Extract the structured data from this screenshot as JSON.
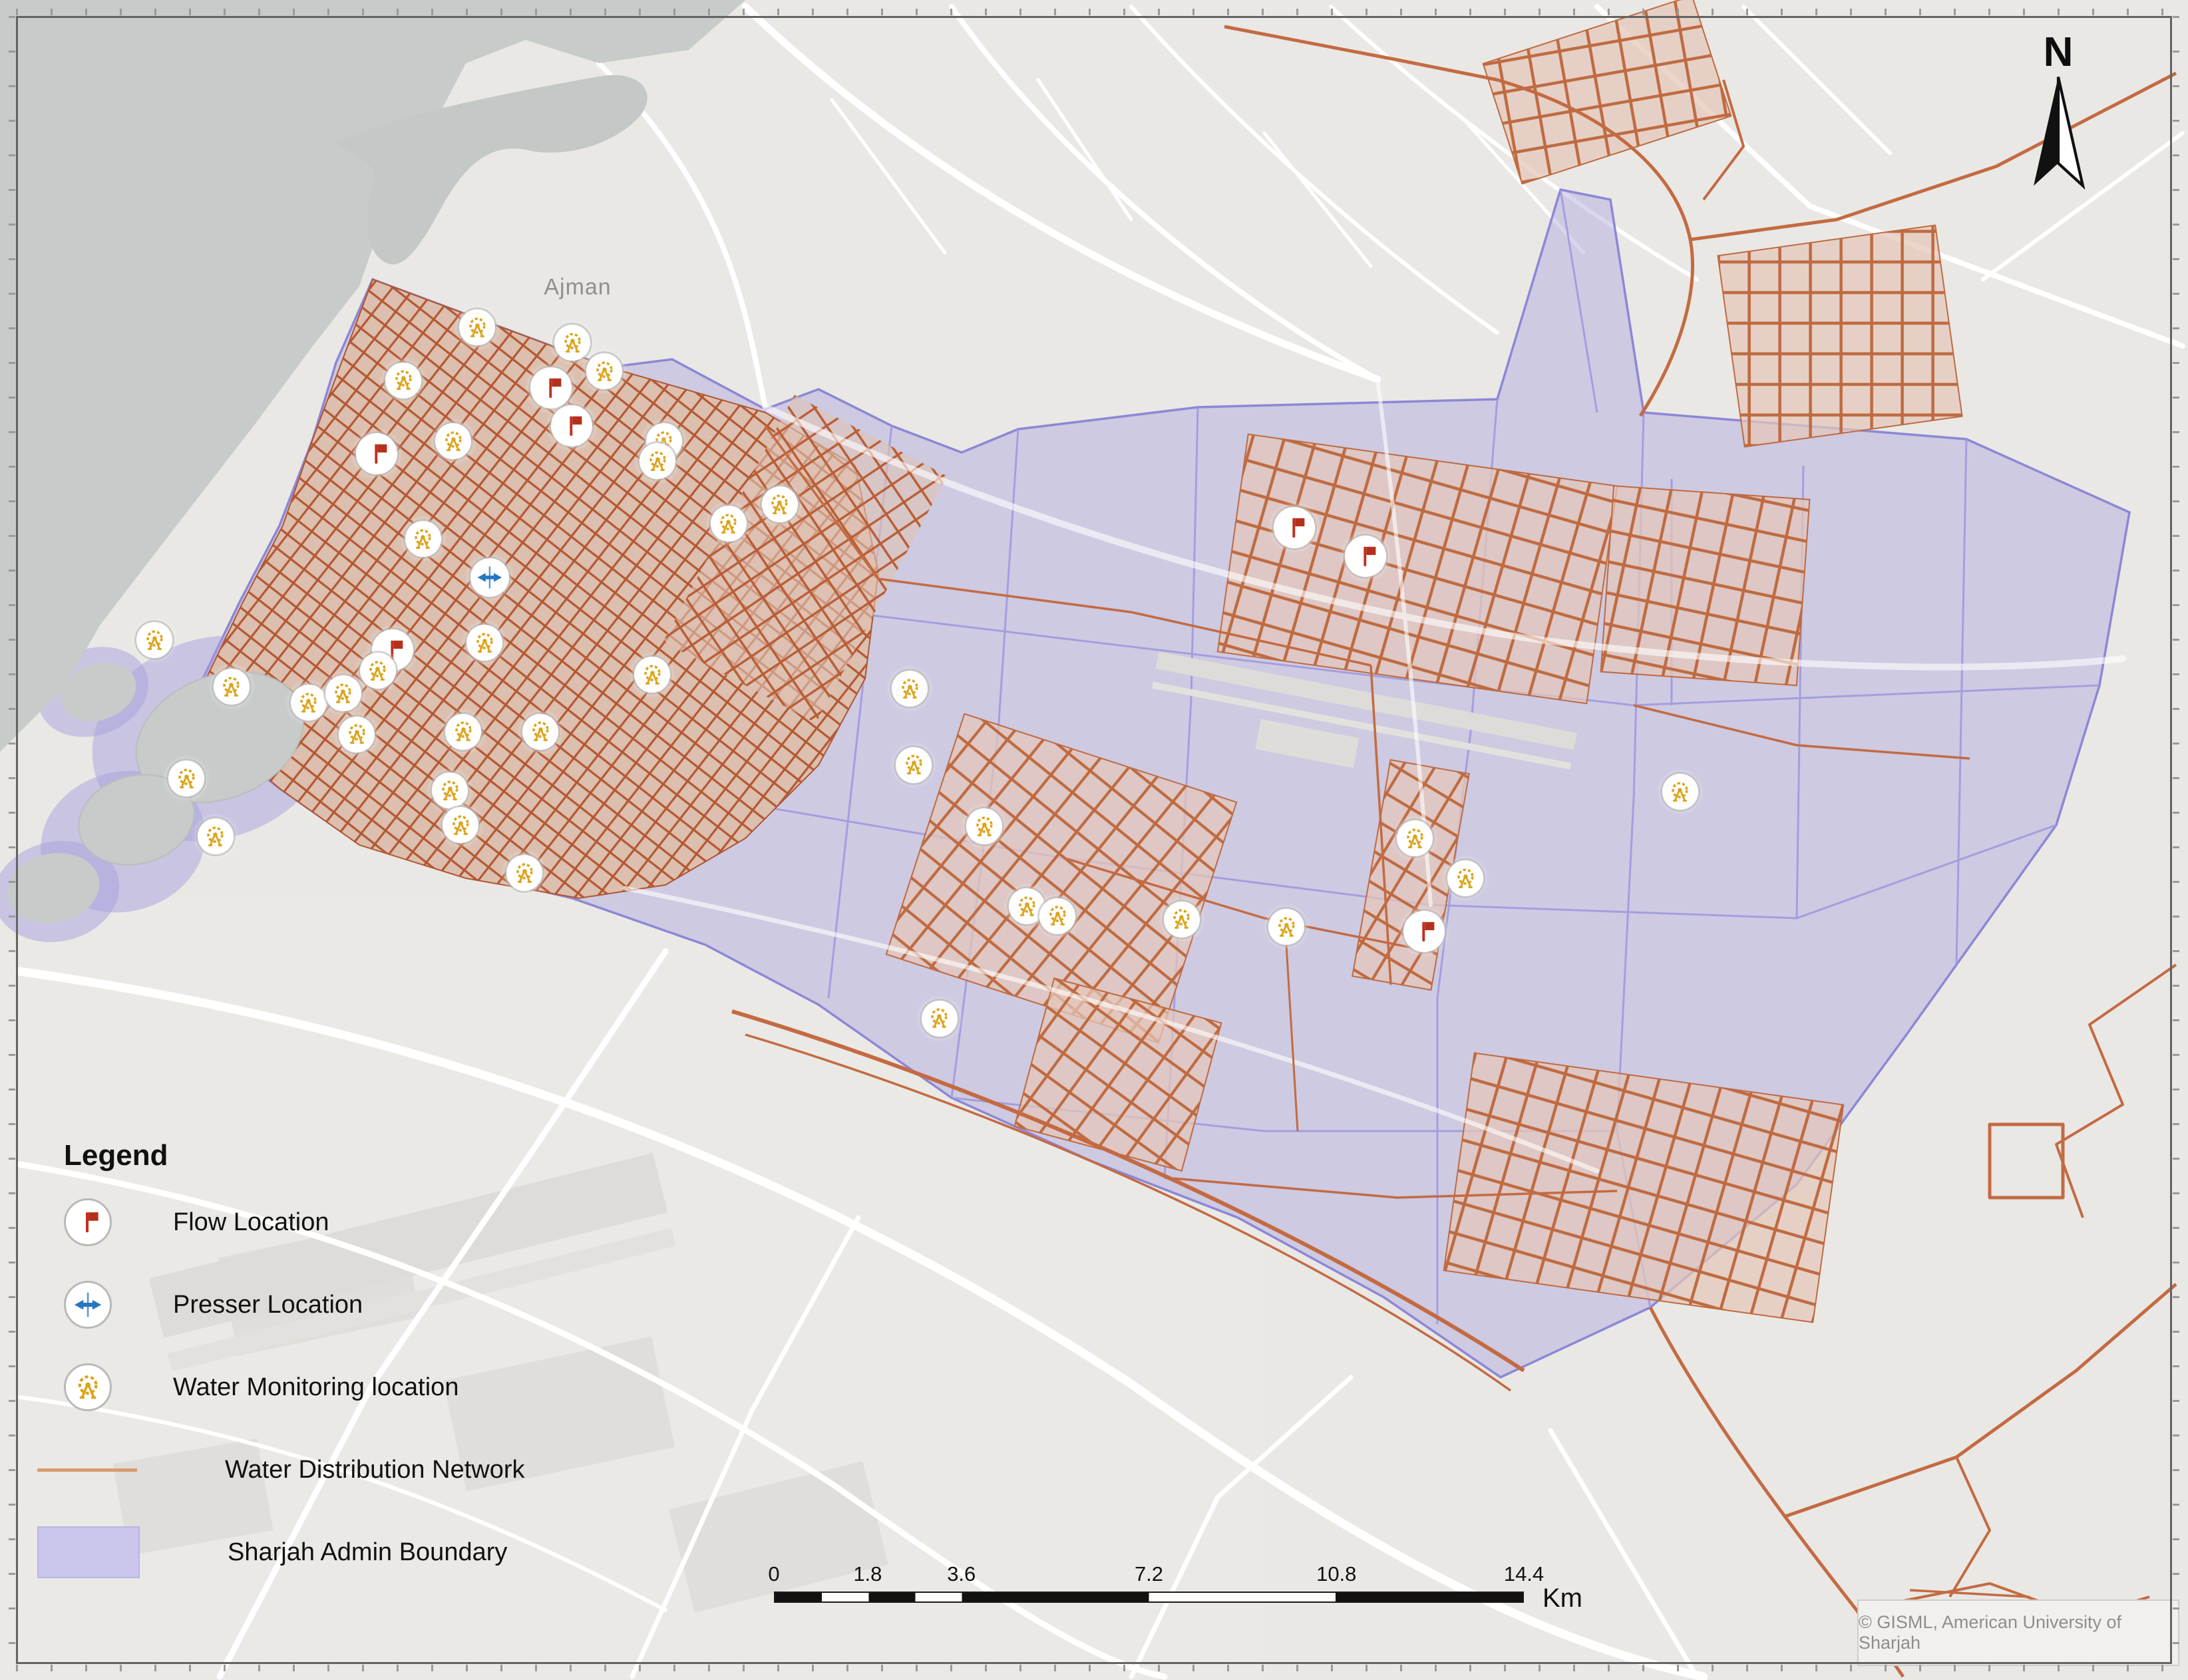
{
  "map": {
    "place_labels": [
      {
        "text": "Ajman",
        "x_pct": 26.4,
        "y_pct": 17.1
      }
    ],
    "north_label": "N",
    "attribution": "© GISML, American University of Sharjah"
  },
  "legend": {
    "title": "Legend",
    "items": [
      {
        "id": "flow",
        "label": "Flow Location",
        "icon": "flow-flag-icon"
      },
      {
        "id": "presser",
        "label": "Presser Location",
        "icon": "presser-arrows-icon"
      },
      {
        "id": "monitoring",
        "label": "Water Monitoring location",
        "icon": "water-monitoring-gauge-icon"
      },
      {
        "id": "network",
        "label": "Water Distribution Network",
        "icon": "network-line-swatch"
      },
      {
        "id": "boundary",
        "label": "Sharjah Admin Boundary",
        "icon": "admin-boundary-swatch"
      }
    ]
  },
  "scale_bar": {
    "tick_labels": [
      "0",
      "1.8",
      "3.6",
      "7.2",
      "10.8",
      "14.4"
    ],
    "max_value": 14.4,
    "unit": "Km"
  },
  "markers": {
    "flow": [
      {
        "x_pct": 25.18,
        "y_pct": 23.1
      },
      {
        "x_pct": 26.13,
        "y_pct": 25.35
      },
      {
        "x_pct": 17.21,
        "y_pct": 27.01
      },
      {
        "x_pct": 17.94,
        "y_pct": 38.69
      },
      {
        "x_pct": 59.15,
        "y_pct": 31.41
      },
      {
        "x_pct": 62.41,
        "y_pct": 33.11
      },
      {
        "x_pct": 65.09,
        "y_pct": 55.45
      }
    ],
    "presser": [
      {
        "x_pct": 22.38,
        "y_pct": 34.38
      }
    ],
    "monitoring": [
      {
        "x_pct": 21.81,
        "y_pct": 19.49
      },
      {
        "x_pct": 26.16,
        "y_pct": 20.4
      },
      {
        "x_pct": 18.43,
        "y_pct": 22.65
      },
      {
        "x_pct": 27.62,
        "y_pct": 22.1
      },
      {
        "x_pct": 20.71,
        "y_pct": 26.26
      },
      {
        "x_pct": 19.34,
        "y_pct": 32.08
      },
      {
        "x_pct": 30.35,
        "y_pct": 26.26
      },
      {
        "x_pct": 30.05,
        "y_pct": 27.45
      },
      {
        "x_pct": 33.3,
        "y_pct": 31.17
      },
      {
        "x_pct": 35.64,
        "y_pct": 30.02
      },
      {
        "x_pct": 22.14,
        "y_pct": 38.26
      },
      {
        "x_pct": 29.81,
        "y_pct": 40.16
      },
      {
        "x_pct": 7.06,
        "y_pct": 38.1
      },
      {
        "x_pct": 10.58,
        "y_pct": 40.87
      },
      {
        "x_pct": 14.11,
        "y_pct": 41.82
      },
      {
        "x_pct": 15.69,
        "y_pct": 41.27
      },
      {
        "x_pct": 17.27,
        "y_pct": 39.92
      },
      {
        "x_pct": 16.3,
        "y_pct": 43.72
      },
      {
        "x_pct": 21.17,
        "y_pct": 43.56
      },
      {
        "x_pct": 24.7,
        "y_pct": 43.56
      },
      {
        "x_pct": 8.52,
        "y_pct": 46.34
      },
      {
        "x_pct": 20.56,
        "y_pct": 47.05
      },
      {
        "x_pct": 21.05,
        "y_pct": 49.11
      },
      {
        "x_pct": 9.85,
        "y_pct": 49.78
      },
      {
        "x_pct": 23.97,
        "y_pct": 51.96
      },
      {
        "x_pct": 41.58,
        "y_pct": 40.99
      },
      {
        "x_pct": 41.76,
        "y_pct": 45.54
      },
      {
        "x_pct": 44.98,
        "y_pct": 49.19
      },
      {
        "x_pct": 46.93,
        "y_pct": 53.94
      },
      {
        "x_pct": 48.33,
        "y_pct": 54.53
      },
      {
        "x_pct": 54.01,
        "y_pct": 54.73
      },
      {
        "x_pct": 58.79,
        "y_pct": 55.17
      },
      {
        "x_pct": 42.94,
        "y_pct": 60.63
      },
      {
        "x_pct": 64.66,
        "y_pct": 49.9
      },
      {
        "x_pct": 66.97,
        "y_pct": 52.28
      },
      {
        "x_pct": 76.79,
        "y_pct": 47.13
      }
    ]
  },
  "colors": {
    "admin_boundary_fill": "#cfcbe9",
    "admin_boundary_line": "#8d87d6",
    "network_line": "#c46a42",
    "monitoring_gold": "#dca41a",
    "flow_red": "#c0301f",
    "presser_blue": "#2677c0",
    "water_gray": "#c7cbca",
    "base_land": "#e9e8e5"
  }
}
